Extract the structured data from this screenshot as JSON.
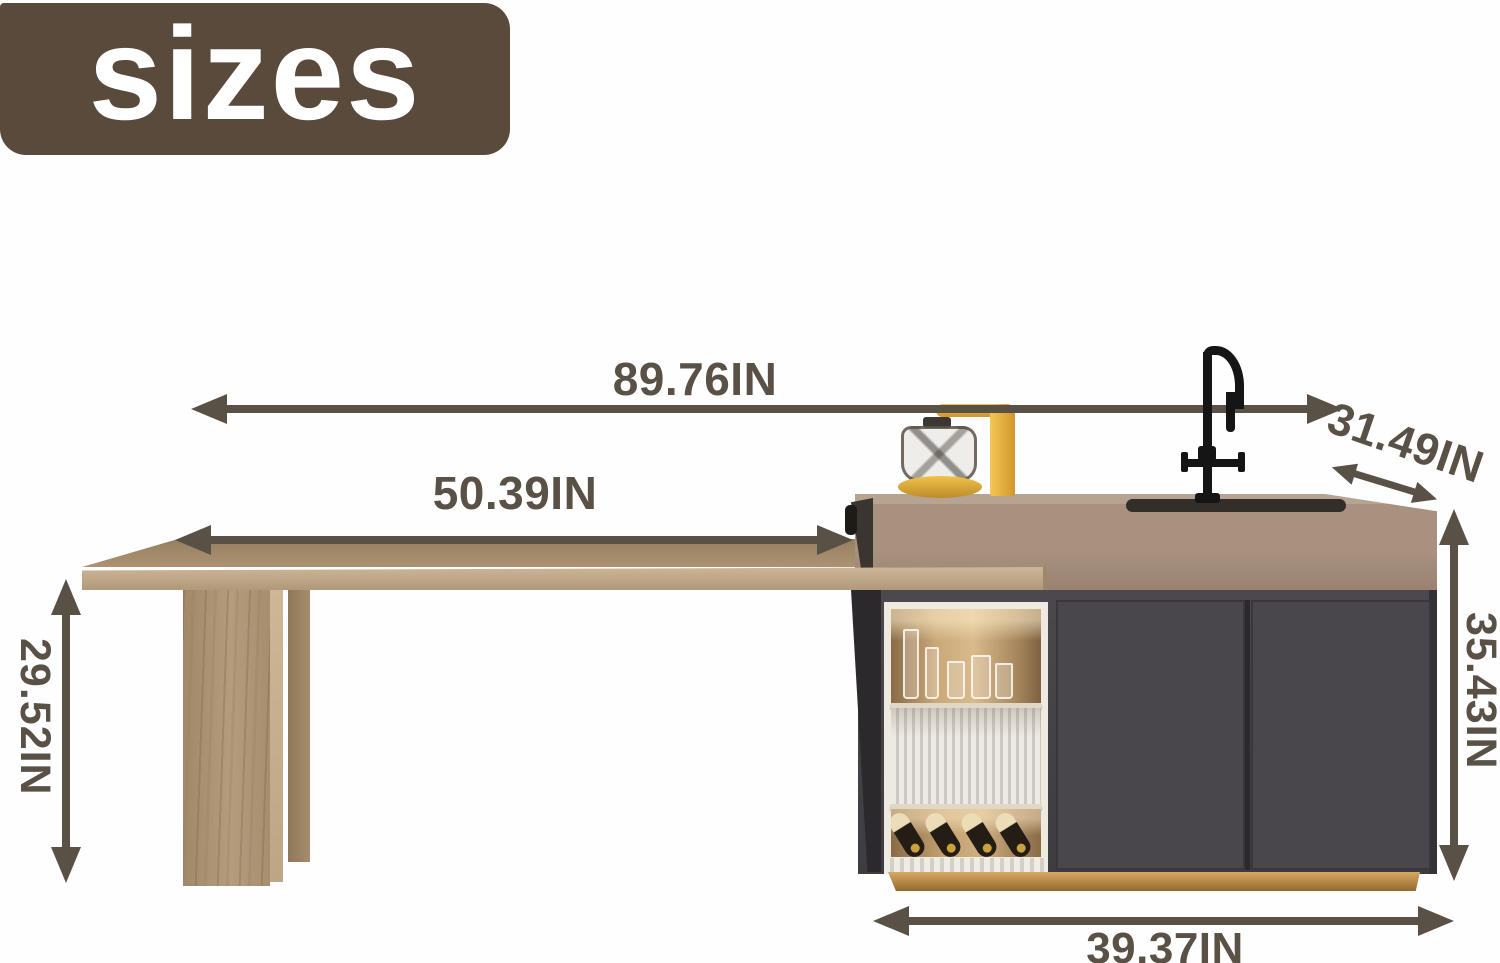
{
  "badge": {
    "label": "sizes"
  },
  "dimensions": {
    "overall_width": {
      "label": "89.76IN"
    },
    "table_length": {
      "label": "50.39IN"
    },
    "island_depth": {
      "label": "31.49IN"
    },
    "table_height": {
      "label": "29.52IN"
    },
    "island_height": {
      "label": "35.43IN"
    },
    "cabinet_width": {
      "label": "39.37IN"
    }
  },
  "colors": {
    "background": "#fefefe",
    "badge_bg": "#5a4a3c",
    "badge_text": "#ffffff",
    "dimension": "#5a5146",
    "counter_front": "#a8917f",
    "counter_top": "#b7a391",
    "cabinet_side": "#2c292c",
    "niche_frame": "#efeadf",
    "fluted_light": "#edeae5",
    "fluted_dark": "#cdc9c2",
    "plinth_gold_light": "#d8a962",
    "plinth_gold_dark": "#8f6a33",
    "faucet_black": "#151515",
    "kettle_yellow": "#e6af3a",
    "bottle_dark": "#241d16",
    "bottle_label": "#ecdcb8"
  }
}
